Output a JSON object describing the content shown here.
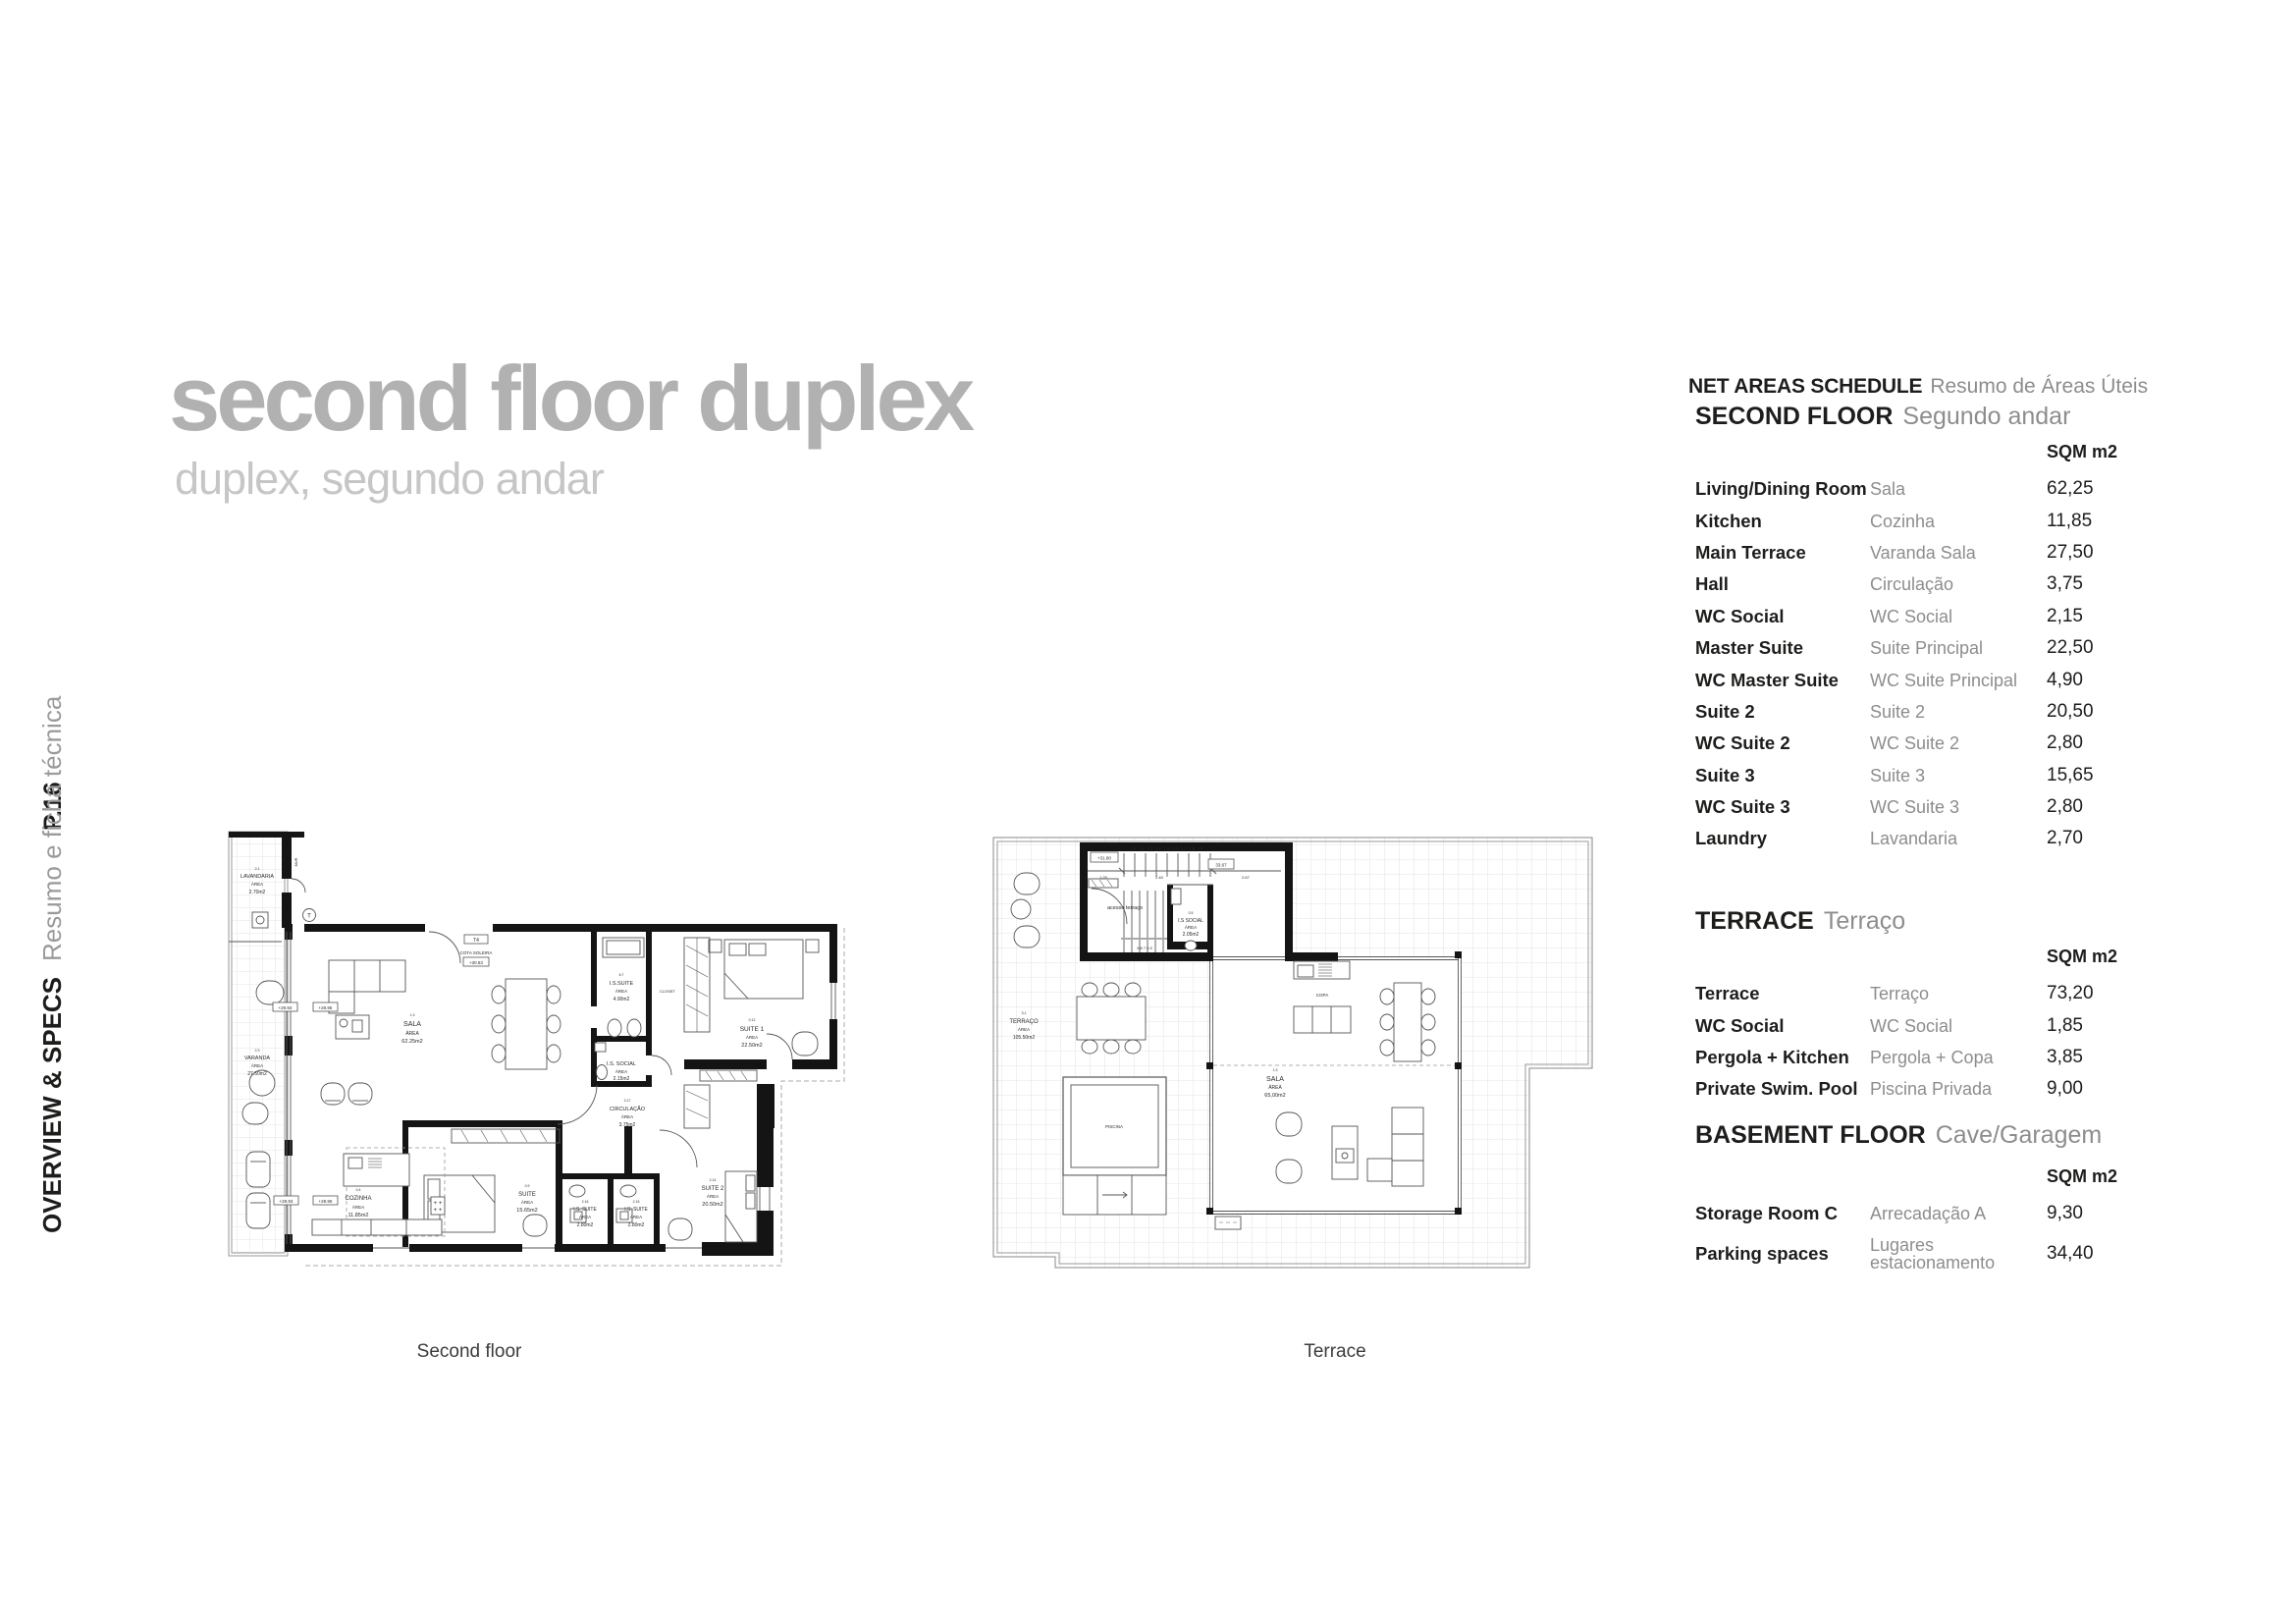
{
  "colors": {
    "title_gray": "#b1b1b1",
    "subtitle_gray": "#c6c6c6",
    "text_black": "#1d1d1b",
    "text_gray": "#8d8d8d"
  },
  "sidebar": {
    "page_number": "P.16",
    "section": "OVERVIEW & SPECS",
    "section_sub": "Resumo e ficha técnica"
  },
  "header": {
    "title": "second floor duplex",
    "subtitle": "duplex, segundo andar"
  },
  "schedule": {
    "title": "NET AREAS SCHEDULE",
    "title_sub": "Resumo de Áreas Úteis",
    "unit_header": "SQM m2",
    "sections": [
      {
        "name": "SECOND FLOOR",
        "name_pt": "Segundo andar",
        "rows": [
          {
            "en": "Living/Dining Room",
            "pt": "Sala",
            "sqm": "62,25"
          },
          {
            "en": "Kitchen",
            "pt": "Cozinha",
            "sqm": "11,85"
          },
          {
            "en": "Main Terrace",
            "pt": "Varanda Sala",
            "sqm": "27,50"
          },
          {
            "en": "Hall",
            "pt": "Circulação",
            "sqm": "3,75"
          },
          {
            "en": "WC Social",
            "pt": "WC Social",
            "sqm": "2,15"
          },
          {
            "en": "Master Suite",
            "pt": "Suite Principal",
            "sqm": "22,50"
          },
          {
            "en": "WC Master Suite",
            "pt": "WC Suite Principal",
            "sqm": "4,90"
          },
          {
            "en": "Suite 2",
            "pt": "Suite 2",
            "sqm": "20,50"
          },
          {
            "en": "WC Suite 2",
            "pt": "WC Suite 2",
            "sqm": "2,80"
          },
          {
            "en": "Suite 3",
            "pt": "Suite 3",
            "sqm": "15,65"
          },
          {
            "en": "WC Suite 3",
            "pt": "WC Suite 3",
            "sqm": "2,80"
          },
          {
            "en": "Laundry",
            "pt": "Lavandaria",
            "sqm": "2,70"
          }
        ]
      },
      {
        "name": "TERRACE",
        "name_pt": "Terraço",
        "rows": [
          {
            "en": "Terrace",
            "pt": "Terraço",
            "sqm": "73,20"
          },
          {
            "en": "WC Social",
            "pt": "WC Social",
            "sqm": "1,85"
          },
          {
            "en": "Pergola + Kitchen",
            "pt": "Pergola + Copa",
            "sqm": "3,85"
          },
          {
            "en": "Private Swim. Pool",
            "pt": "Piscina Privada",
            "sqm": "9,00"
          }
        ]
      },
      {
        "name": "BASEMENT FLOOR",
        "name_pt": "Cave/Garagem",
        "rows": [
          {
            "en": "Storage Room C",
            "pt": "Arrecadação A",
            "sqm": "9,30"
          },
          {
            "en": "Parking spaces",
            "pt": "Lugares estacionamento",
            "sqm": "34,40"
          }
        ]
      }
    ]
  },
  "plans": {
    "second_floor": {
      "caption": "Second floor",
      "markers": {
        "m1": "+29.93",
        "m2": "+29.95",
        "m3": "+29.93",
        "m4": "+29.95",
        "t4": "T4",
        "cota": "COTA SOLEIRA",
        "cota_val": "+30.53",
        "mur": "MUR",
        "t": "T"
      },
      "rooms": {
        "lavandaria": [
          "2.1",
          "LAVANDARIA",
          "ÁREA",
          "2.70m2"
        ],
        "varanda": [
          "2.3",
          "VARANDA",
          "ÁREA",
          "27.50m2"
        ],
        "sala": [
          "1.3",
          "SALA",
          "ÁREA",
          "62.25m2"
        ],
        "is_suite": [
          "6.7",
          "I.S.SUITE",
          "ÁREA",
          "4.90m2"
        ],
        "closet": [
          "CLOSET"
        ],
        "suite1": [
          "0.12",
          "SUITE 1",
          "ÁREA",
          "22.50m2"
        ],
        "is_social": [
          "I.S. SOCIAL",
          "ÁREA",
          "2.15m2"
        ],
        "circulacao": [
          "2.17",
          "CIRCULAÇÃO",
          "ÁREA",
          "3.75m2"
        ],
        "cozinha": [
          "0.4",
          "COZINHA",
          "ÁREA",
          "11.85m2"
        ],
        "suite": [
          "0.9",
          "SUITE",
          "ÁREA",
          "15.65m2"
        ],
        "is_suite2": [
          "2.16",
          "I.S. SUITE",
          "ÁREA",
          "2.80m2"
        ],
        "is_suite3": [
          "2.15",
          "I.S. SUITE",
          "ÁREA",
          "2.80m2"
        ],
        "suite2": [
          "2.14",
          "SUITE 2",
          "ÁREA",
          "20.50m2"
        ]
      }
    },
    "terrace": {
      "caption": "Terrace",
      "markers": {
        "lvl": "+31.80",
        "dim_total": "33.67",
        "d1": "1.20",
        "d2": "2.40",
        "d3": "2.67",
        "stairs_up": "10 11 13 14 15 16 17 18 19",
        "stairs_dn": "9 8 7 6 5"
      },
      "rooms": {
        "acesso": [
          "acesso terraço"
        ],
        "is_social": [
          "0.5",
          "I.S SOCIAL",
          "ÁREA",
          "2.05m2"
        ],
        "terraco": [
          "3.1",
          "TERRAÇO",
          "ÁREA",
          "105.50m2"
        ],
        "piscina": [
          "PISCINA"
        ],
        "sala": [
          "1.3",
          "SALA",
          "ÁREA",
          "65,00m2"
        ],
        "copa": [
          "COPA"
        ]
      }
    }
  }
}
